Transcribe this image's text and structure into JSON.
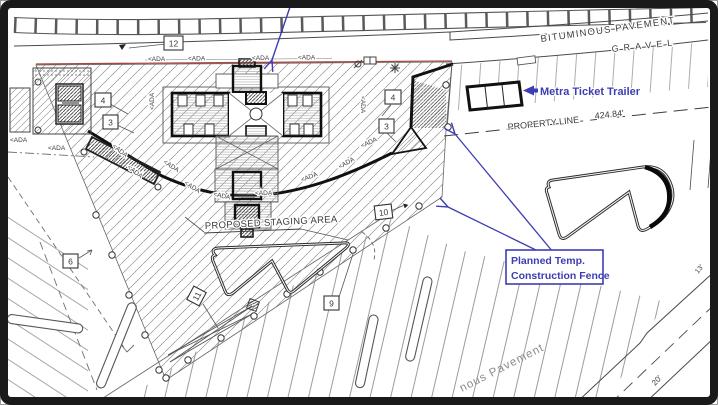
{
  "drawing": {
    "labels": {
      "bituminous_pavement": "BITUMINOUS PAVEMENT",
      "gravel": "GRAVEL",
      "property_line": "PROPERTY LINE",
      "property_line_length": "424.84'",
      "proposed_staging_area": "PROPOSED STAGING AREA",
      "pavement_lower": "nous Pavement",
      "dim_20ft": "20'",
      "dim_13ft": "13'",
      "ada_marker": "<ADA"
    },
    "annotations": {
      "metra_ticket_trailer": "Metra Ticket Trailer",
      "planned_fence_line1": "Planned Temp.",
      "planned_fence_line2": "Construction Fence"
    },
    "callouts": {
      "n12": "12",
      "n4": "4",
      "n3": "3",
      "n6": "6",
      "n9": "9",
      "n10": "10",
      "n11": "11"
    },
    "colors": {
      "annotation_blue": "#3d3db4",
      "limit_line_red": "#a8473f",
      "line_dark": "#2e2e2e"
    }
  }
}
